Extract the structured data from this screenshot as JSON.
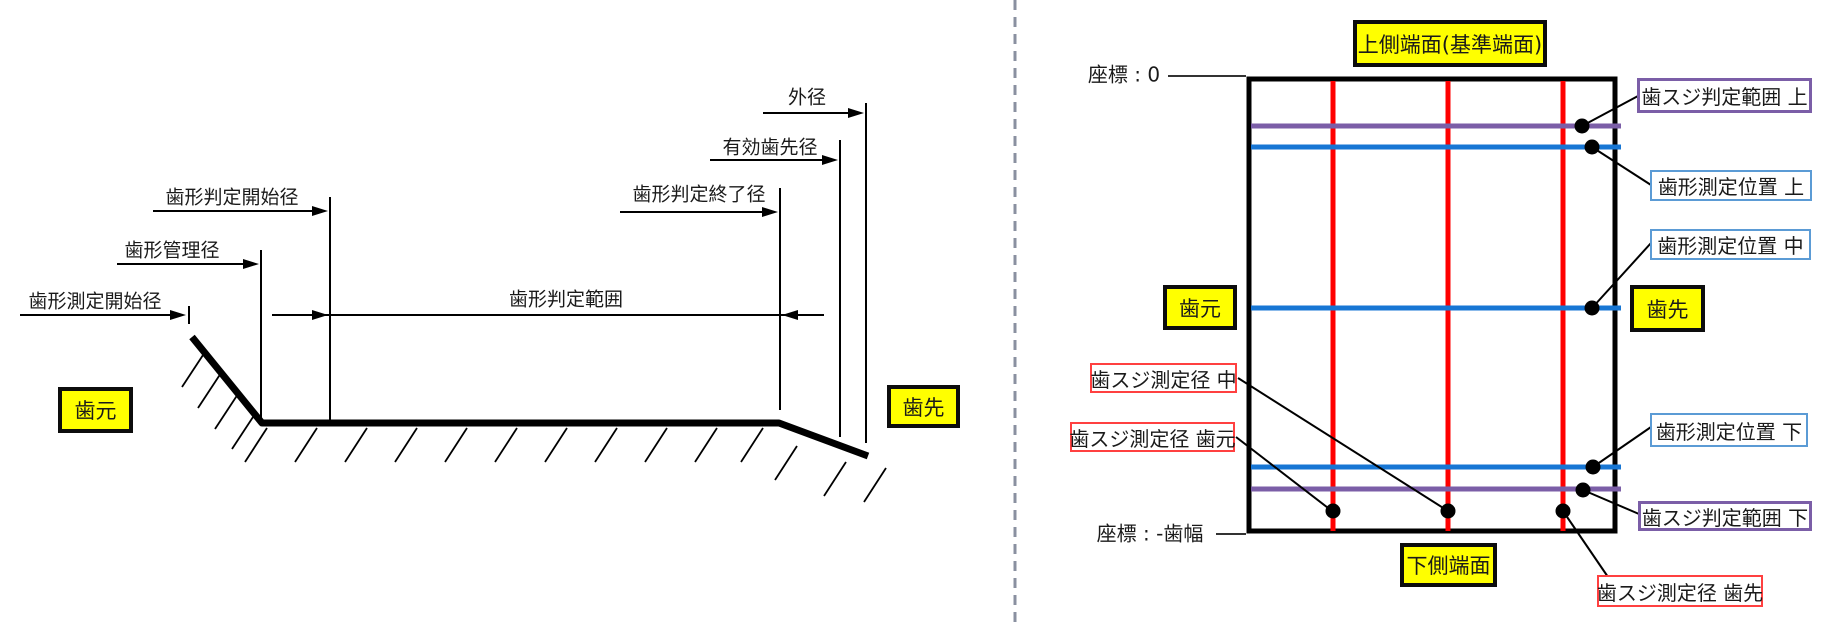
{
  "colors": {
    "yellow": "#ffff00",
    "red": "#ff0000",
    "blue": "#1776d4",
    "purple": "#7b5ea7",
    "blue_border": "#5b9bd5",
    "purple_border": "#7b5ea7",
    "red_border": "#ff4040",
    "separator": "#8a90a0"
  },
  "left": {
    "outer_diameter": "外径",
    "effective_tip_diameter": "有効歯先径",
    "profile_judge_end_diameter": "歯形判定終了径",
    "profile_judge_start_diameter": "歯形判定開始径",
    "profile_control_diameter": "歯形管理径",
    "profile_measure_start_diameter": "歯形測定開始径",
    "profile_judge_range": "歯形判定範囲",
    "tooth_root": "歯元",
    "tooth_tip": "歯先"
  },
  "right": {
    "upper_end_face": "上側端面(基準端面)",
    "coordinate_top": "座標 : 0",
    "trace_judge_range_upper": "歯スジ判定範囲 上",
    "profile_measure_pos_upper": "歯形測定位置 上",
    "profile_measure_pos_middle": "歯形測定位置 中",
    "tooth_root": "歯元",
    "tooth_tip": "歯先",
    "trace_measure_dia_middle": "歯スジ測定径 中",
    "trace_measure_dia_root": "歯スジ測定径 歯元",
    "profile_measure_pos_lower": "歯形測定位置 下",
    "trace_judge_range_lower": "歯スジ判定範囲 下",
    "coordinate_bottom": "座標 : -歯幅",
    "lower_end_face": "下側端面",
    "trace_measure_dia_tip": "歯スジ測定径 歯先"
  }
}
